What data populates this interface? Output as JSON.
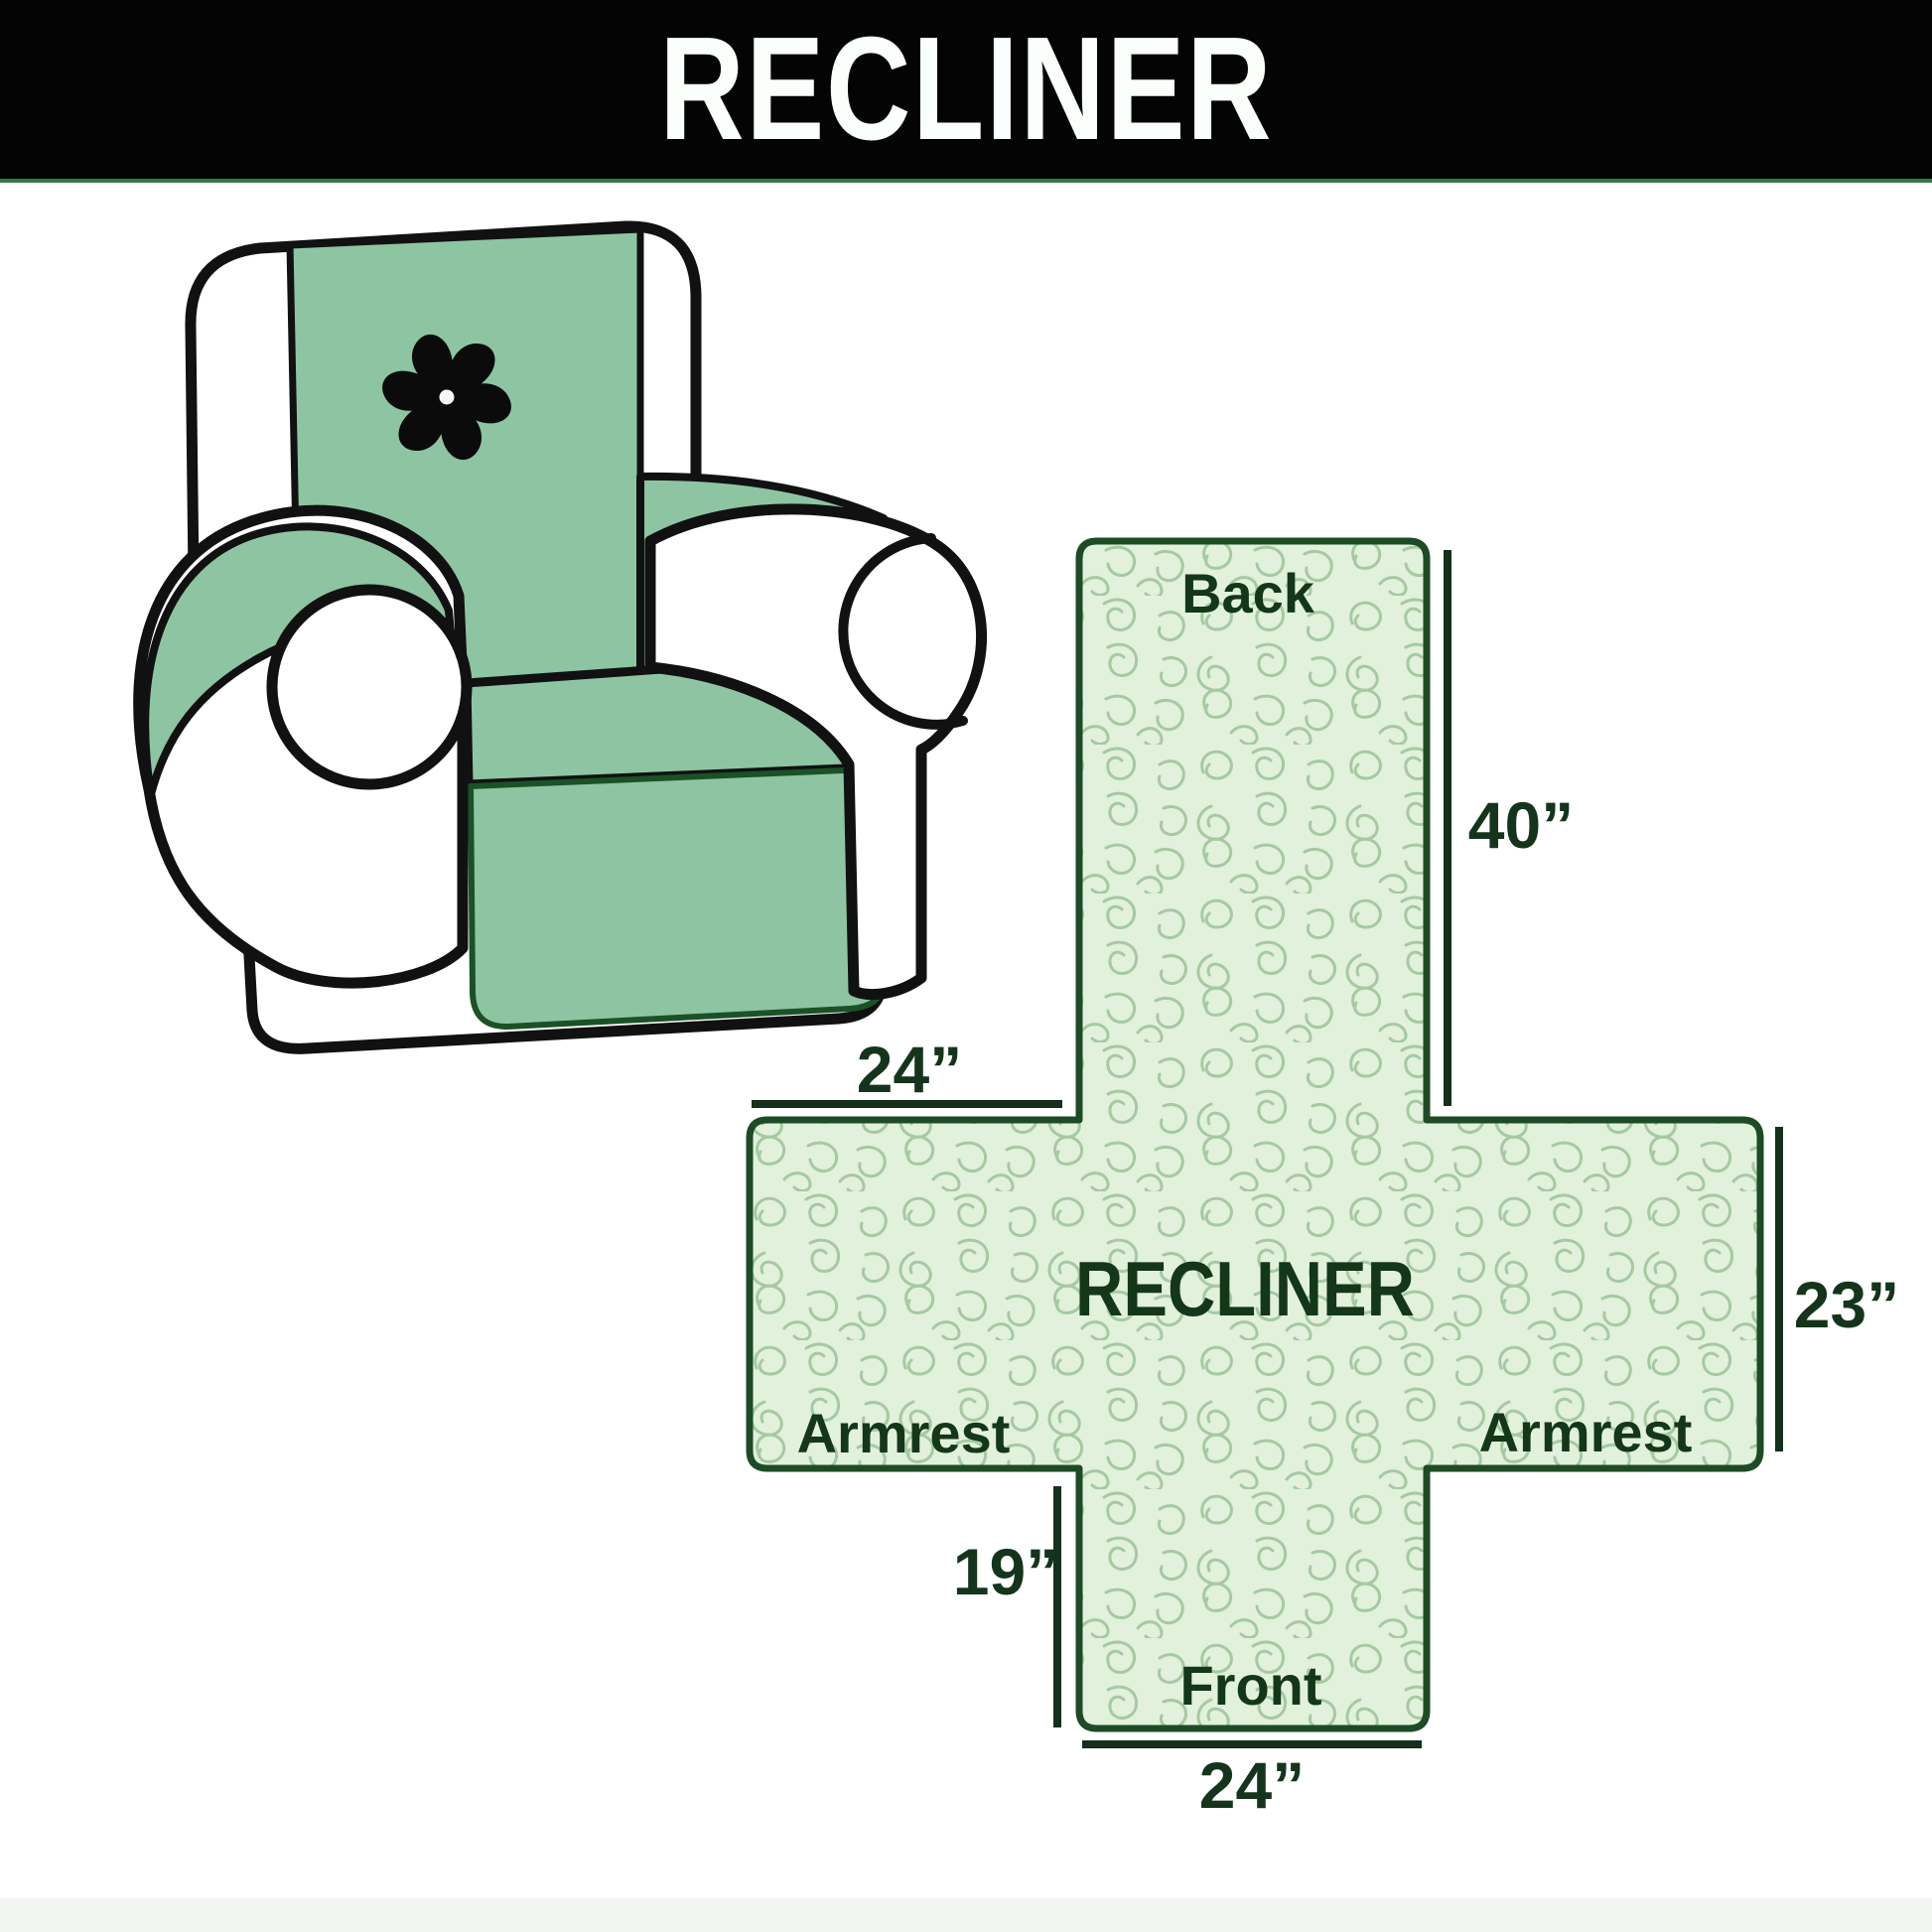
{
  "banner": {
    "title": "RECLINER",
    "bg_color": "#040404",
    "text_color": "#fbfffb",
    "accent_line_color": "#2e7b44"
  },
  "illustration": {
    "description": "armchair with quilted protector cover draped over back, seat and armrests",
    "logo_icon": "pinwheel-fan",
    "cover_color": "#8dc5a2",
    "outline_color": "#111111"
  },
  "diagram": {
    "center_label": "RECLINER",
    "sections": {
      "back": "Back",
      "armrest_left": "Armrest",
      "armrest_right": "Armrest",
      "front": "Front"
    },
    "dimensions": {
      "armrest_top_width": "24”",
      "back_length": "40”",
      "side_height": "23”",
      "front_length": "19”",
      "front_bottom_width": "24”"
    },
    "fill_color": "#e1f1dc",
    "pattern_color": "#a6c9a2",
    "border_color": "#1d4b25",
    "label_color": "#143619",
    "dimension_line_color": "#14301b"
  }
}
